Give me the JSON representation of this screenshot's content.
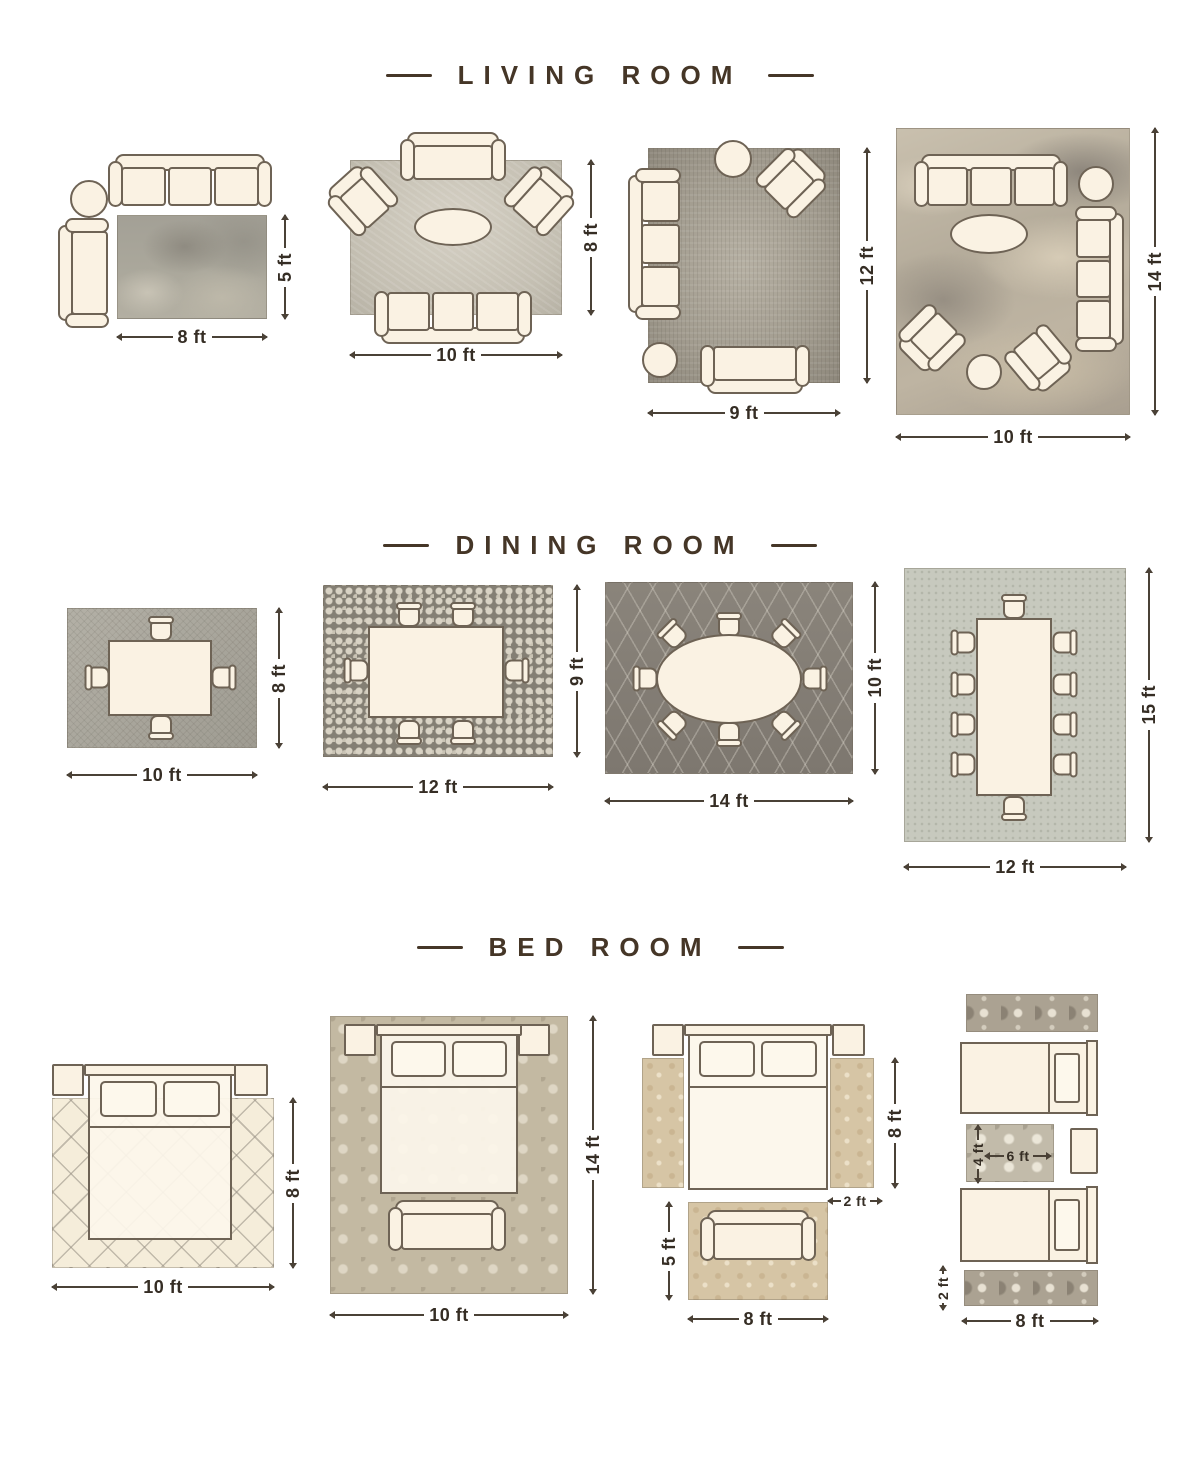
{
  "colors": {
    "background": "#ffffff",
    "title_color": "#453627",
    "dimension_text": "#352d24",
    "furniture_outline": "#6e6355",
    "furniture_fill": "#faf2e3"
  },
  "sections": [
    {
      "title": "LIVING ROOM",
      "layouts": [
        {
          "labels": {
            "width": "8 ft",
            "height": "5 ft"
          }
        },
        {
          "labels": {
            "width": "10 ft",
            "height": "8 ft"
          }
        },
        {
          "labels": {
            "width": "9 ft",
            "height": "12 ft"
          }
        },
        {
          "labels": {
            "width": "10 ft",
            "height": "14 ft"
          }
        }
      ]
    },
    {
      "title": "DINING ROOM",
      "layouts": [
        {
          "labels": {
            "width": "10 ft",
            "height": "8 ft"
          }
        },
        {
          "labels": {
            "width": "12 ft",
            "height": "9 ft"
          }
        },
        {
          "labels": {
            "width": "14 ft",
            "height": "10 ft"
          }
        },
        {
          "labels": {
            "width": "12 ft",
            "height": "15 ft"
          }
        }
      ]
    },
    {
      "title": "BED ROOM",
      "layouts": [
        {
          "labels": {
            "width": "10 ft",
            "height": "8 ft"
          }
        },
        {
          "labels": {
            "width": "10 ft",
            "height": "14 ft"
          }
        },
        {
          "labels": {
            "side_runner_length": "8 ft",
            "runner_width": "2 ft",
            "front_rug_height": "5 ft",
            "front_rug_width": "8 ft"
          }
        },
        {
          "labels": {
            "mid_rug_height": "4 ft",
            "mid_rug_width": "6 ft",
            "runner_height": "2 ft",
            "runner_length": "8 ft"
          }
        }
      ]
    }
  ]
}
